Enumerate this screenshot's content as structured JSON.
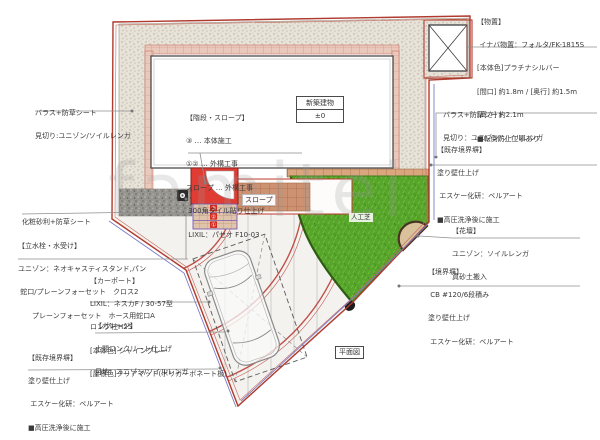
{
  "watermark": "famitei",
  "plan_labels": {
    "building": "新築建物",
    "building_level": "±0",
    "slope": "スロープ",
    "turf": "人工芝",
    "plan_view": "平面図"
  },
  "step_numbers": [
    "③",
    "②",
    "①"
  ],
  "notes": {
    "storage": {
      "lines": [
        "【物置】",
        " イナバ物置：フォルタ/FK-1815S",
        "[本体色]プラチナシルバー",
        "[間口] 約1.8m / [奥行] 約1.5m",
        "[高さ] 約2.1m",
        "■転倒防止工事あり"
      ]
    },
    "ballast_left": {
      "lines": [
        "バラス+防草シート",
        "見切り:ユニゾン/ソイルレンガ"
      ]
    },
    "deco_gravel": {
      "lines": [
        "化粧砂利+防草シート"
      ]
    },
    "stairs_slope": {
      "lines": [
        "【階段・スロープ】",
        "③ … 本体施工",
        "①② … 外構工事",
        "スロープ … 外構工事",
        " 300角タイル貼り仕上げ",
        " LIXIL：パセオ F10-03"
      ]
    },
    "ballast_right": {
      "lines": [
        "バラス+防草シート",
        "見切り：ユニゾン/ソイルレンガ"
      ]
    },
    "existing_wall_right": {
      "lines": [
        "【既存境界塀】",
        "塗り壁仕上げ",
        " エスケー化研：ベルアート",
        "■高圧洗浄後に施工"
      ]
    },
    "flower_bed": {
      "lines": [
        "【花壇】",
        "ユニゾン：ソイルレンガ",
        "真砂土搬入"
      ]
    },
    "boundary_wall": {
      "lines": [
        "【境界塀】",
        " CB #120/6段積み",
        "塗り壁仕上げ",
        " エスケー化研：ベルアート"
      ]
    },
    "tap": {
      "lines": [
        "【立水栓・水受け】",
        "ユニゾン：ネオキャスティスタンド,パン",
        " 蛇口/プレーンフォーセット　クロス2",
        "　　プレーンフォーセット　ホース用蛇口A"
      ]
    },
    "carport": {
      "lines": [
        "【カーポート】",
        "LIXIL：ネスカF / 30-57型",
        "ロング柱H25",
        "[本体色] シャイングレー",
        "[屋根色]クリアマット(ポリカーボネート板)"
      ]
    },
    "garage": {
      "lines": [
        "【ガレージ】",
        "土間コンクリート仕上げ",
        "目地：ユニゾン/ソイルレンガ"
      ]
    },
    "existing_wall_left": {
      "lines": [
        "【既存境界塀】",
        "塗り壁仕上げ",
        " エスケー化研：ベルアート",
        "■高圧洗浄後に施工"
      ]
    }
  },
  "colors": {
    "boundary_red": "#b03a2e",
    "property_blue": "#7b7bc4",
    "turf_green": "#57a52b",
    "porch_red": "#e03c34",
    "tile_brown": "#cd9271",
    "flowerbed_tan": "#d9c19b",
    "gravel_beige": "#e8e3d8",
    "deco_gravel_gray": "#96948e"
  }
}
